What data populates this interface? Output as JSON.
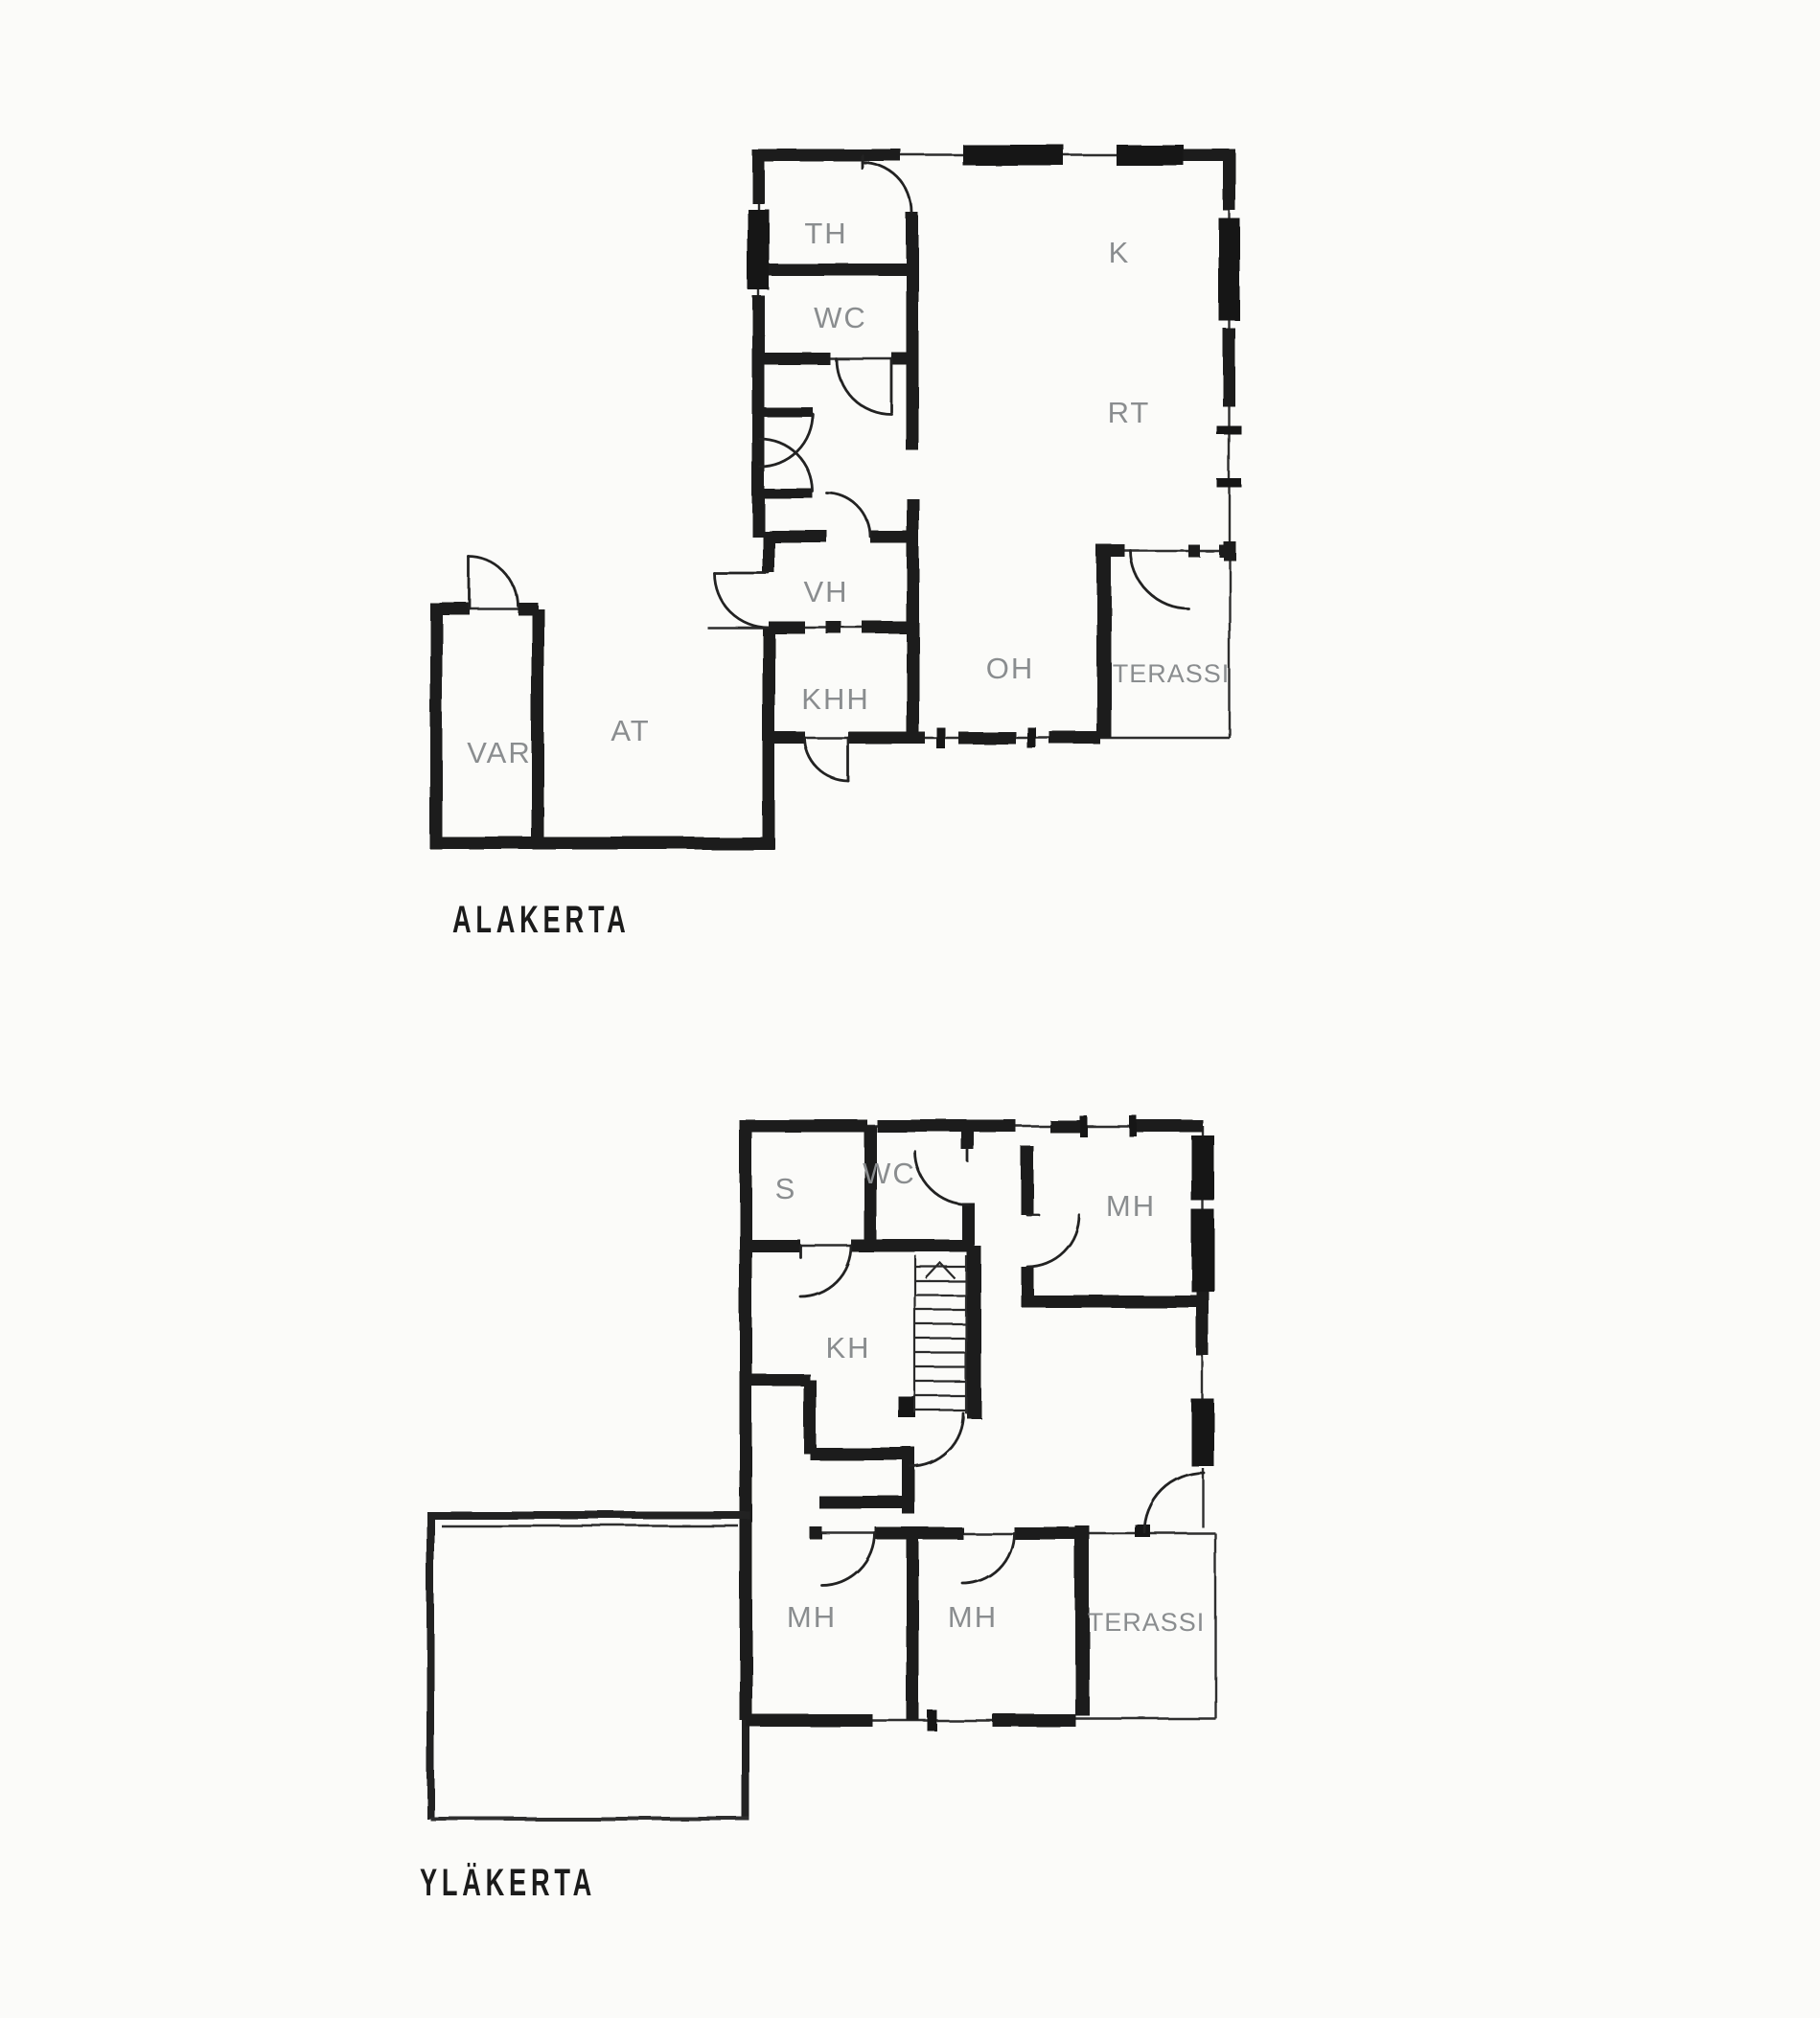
{
  "drawing": {
    "type": "floor-plan",
    "ink_color": "#1b1b1b",
    "label_color": "#8a8d8f",
    "paper_color": "#fbfbf9"
  },
  "plans": [
    {
      "title": "ALAKERTA",
      "rooms": [
        {
          "label": "TH"
        },
        {
          "label": "K"
        },
        {
          "label": "WC"
        },
        {
          "label": "RT"
        },
        {
          "label": "VH"
        },
        {
          "label": "OH"
        },
        {
          "label": "TERASSI"
        },
        {
          "label": "KHH"
        },
        {
          "label": "AT"
        },
        {
          "label": "VAR"
        }
      ]
    },
    {
      "title": "YLÄKERTA",
      "rooms": [
        {
          "label": "S"
        },
        {
          "label": "WC"
        },
        {
          "label": "MH"
        },
        {
          "label": "KH"
        },
        {
          "label": "MH"
        },
        {
          "label": "MH"
        },
        {
          "label": "TERASSI"
        }
      ]
    }
  ]
}
